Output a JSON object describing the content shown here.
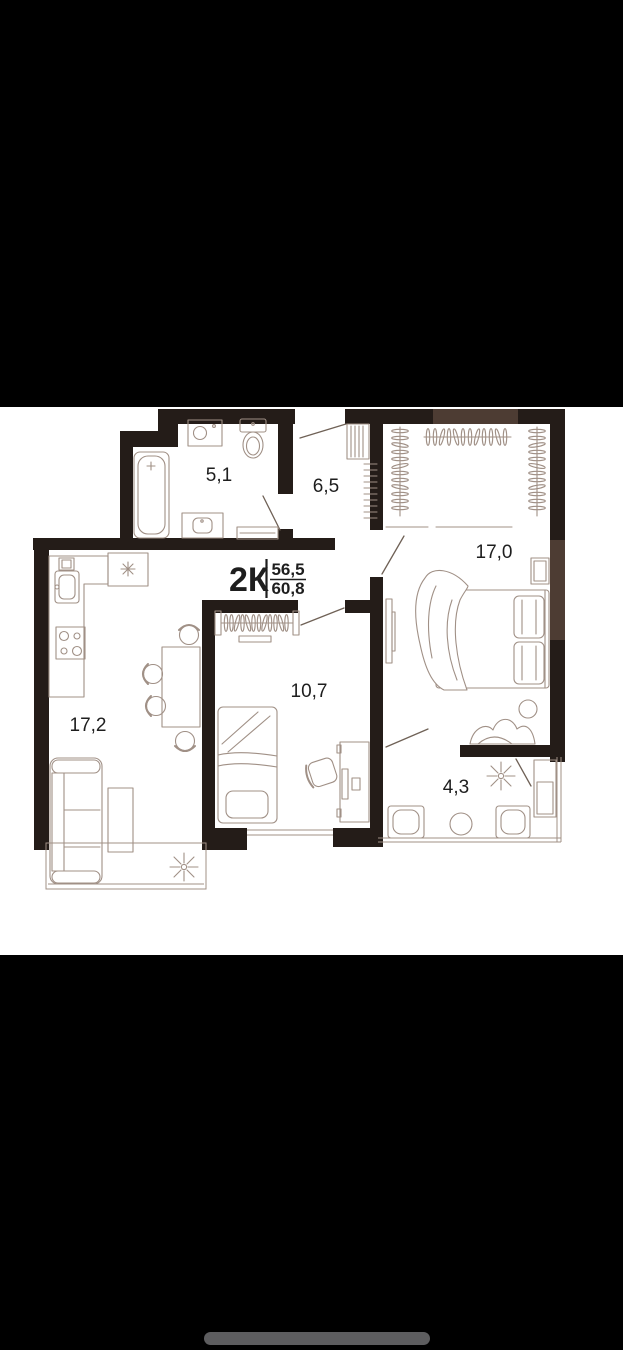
{
  "plan": {
    "title": {
      "rooms_type": "2К",
      "separator": "|",
      "area_top": "56,5",
      "area_bottom": "60,8"
    },
    "rooms": [
      {
        "name": "bathroom",
        "area_label": "5,1"
      },
      {
        "name": "hallway",
        "area_label": "6,5"
      },
      {
        "name": "bedroom",
        "area_label": "17,0"
      },
      {
        "name": "kitchen-living-room",
        "area_label": "17,2"
      },
      {
        "name": "room",
        "area_label": "10,7"
      },
      {
        "name": "balcony",
        "area_label": "4,3"
      }
    ],
    "colors": {
      "wall": "#241c18",
      "wall-light": "#4d3c33",
      "furniture": "#a09086",
      "door": "#6f6156",
      "text": "#1e1e1e",
      "paper": "#ffffff",
      "letterbox": "#000000",
      "home-indicator": "#5d5d5f"
    }
  }
}
